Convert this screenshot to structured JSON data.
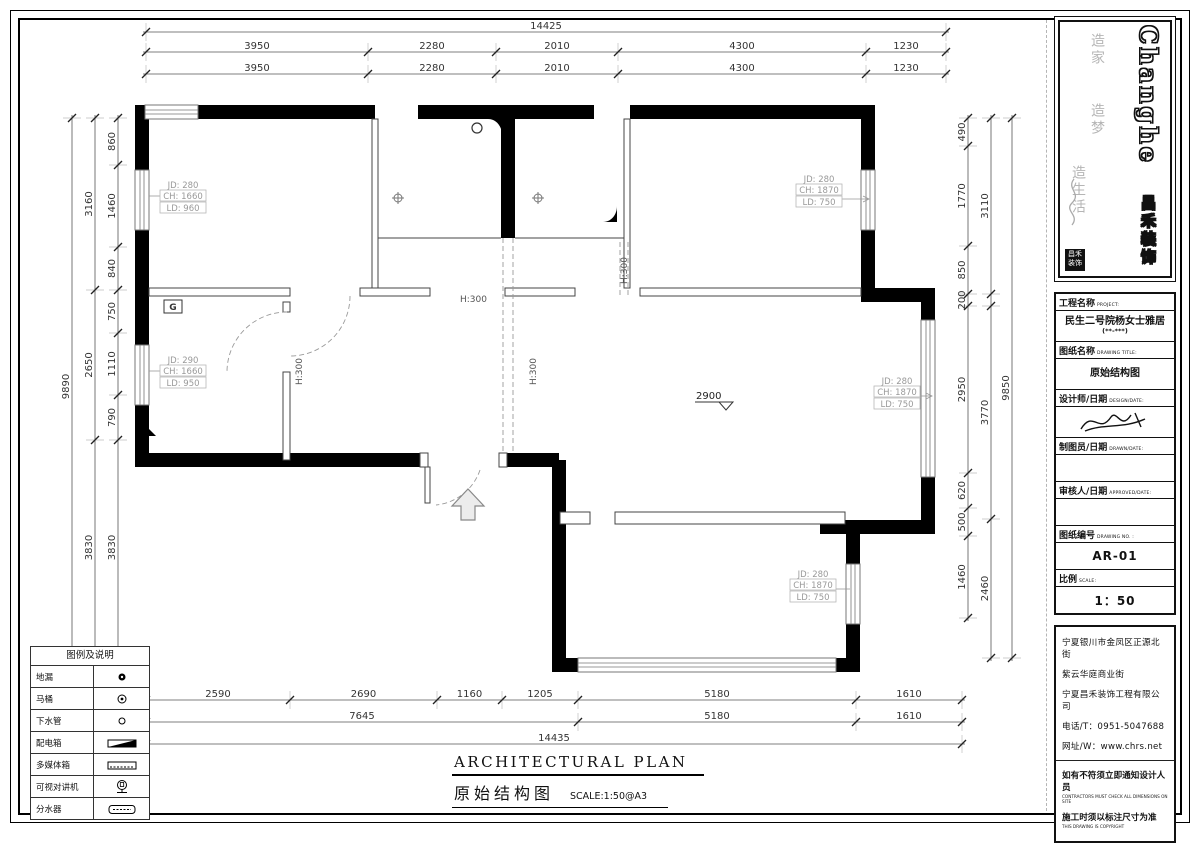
{
  "logo": {
    "brand": "Changhe",
    "brand_cn": "昌禾装饰",
    "slogan1": "造家",
    "slogan2": "造梦",
    "slogan3": "造生活",
    "seal_line1": "昌禾",
    "seal_line2": "装饰"
  },
  "title_block": {
    "project_label": "工程名称",
    "project_label_en": "PROJECT:",
    "project_name": "民生二号院杨女士雅居",
    "project_sub": "(**-***)",
    "drawing_label": "图纸名称",
    "drawing_label_en": "DRAWING TITLE:",
    "drawing_name": "原始结构图",
    "designer_label": "设计师/日期",
    "designer_label_en": "DESIGN/DATE:",
    "drafter_label": "制图员/日期",
    "drafter_label_en": "DRAWN/DATE:",
    "auditor_label": "审核人/日期",
    "auditor_label_en": "APPROVED/DATE:",
    "no_label": "图纸编号",
    "no_label_en": "DRAWING NO. :",
    "drawing_no": "AR-01",
    "scale_label": "比例",
    "scale_label_en": "SCALE:",
    "scale_value": "1：50",
    "address1": "宁夏银川市金凤区正源北街",
    "address2": "紫云华庭商业街",
    "company": "宁夏昌禾装饰工程有限公司",
    "phone": "电话/T：0951-5047688",
    "web": "网址/W：www.chrs.net",
    "note1": "如有不符须立即通知设计人员",
    "note1_en": "CONTRACTORS MUST CHECK ALL DIMENSIONS ON SITE",
    "note2": "施工时须以标注尺寸为准",
    "note2_en": "THIS DRAWING IS COPYRIGHT"
  },
  "legend": {
    "title": "图例及说明",
    "items": [
      {
        "label": "地漏",
        "symbol": "floor-drain"
      },
      {
        "label": "马桶",
        "symbol": "toilet"
      },
      {
        "label": "下水管",
        "symbol": "down-pipe"
      },
      {
        "label": "配电箱",
        "symbol": "power-box"
      },
      {
        "label": "多媒体箱",
        "symbol": "media-box"
      },
      {
        "label": "可视对讲机",
        "symbol": "intercom"
      },
      {
        "label": "分水器",
        "symbol": "manifold"
      }
    ]
  },
  "plan_title": {
    "en": "ARCHITECTURAL PLAN",
    "cn": "原始结构图",
    "scale": "SCALE:1:50@A3"
  },
  "dimensions": {
    "top_total": "14425",
    "top_row": [
      "3950",
      "2280",
      "2010",
      "4300",
      "1230"
    ],
    "bottom_row1": [
      "2590",
      "2690",
      "1160",
      "1205",
      "5180",
      "1610"
    ],
    "bottom_row2": [
      "7645",
      "5180",
      "1610"
    ],
    "bottom_total": "14435",
    "left_inner": [
      "860",
      "1460",
      "840",
      "750",
      "1110",
      "790",
      "3830",
      "560"
    ],
    "left_mid": [
      "3160",
      "2650",
      "3830"
    ],
    "left_total": "9890",
    "right_inner": [
      "490",
      "1770",
      "850",
      "200",
      "2950",
      "620",
      "500",
      "1460"
    ],
    "right_mid": [
      "3110",
      "",
      "3770",
      "2460"
    ],
    "right_total": "9850"
  },
  "windows": {
    "tl": {
      "jd": "JD: 280",
      "ch": "CH: 1660",
      "ld": "LD: 960"
    },
    "ml": {
      "jd": "JD: 290",
      "ch": "CH: 1660",
      "ld": "LD: 950"
    },
    "tr": {
      "jd": "JD: 280",
      "ch": "CH: 1870",
      "ld": "LD: 750"
    },
    "mr": {
      "jd": "JD: 280",
      "ch": "CH: 1870",
      "ld": "LD: 750"
    },
    "br": {
      "jd": "JD: 280",
      "ch": "CH: 1870",
      "ld": "LD: 750"
    }
  },
  "marks": {
    "h300": "H:300",
    "level": "2900",
    "g": "G"
  }
}
